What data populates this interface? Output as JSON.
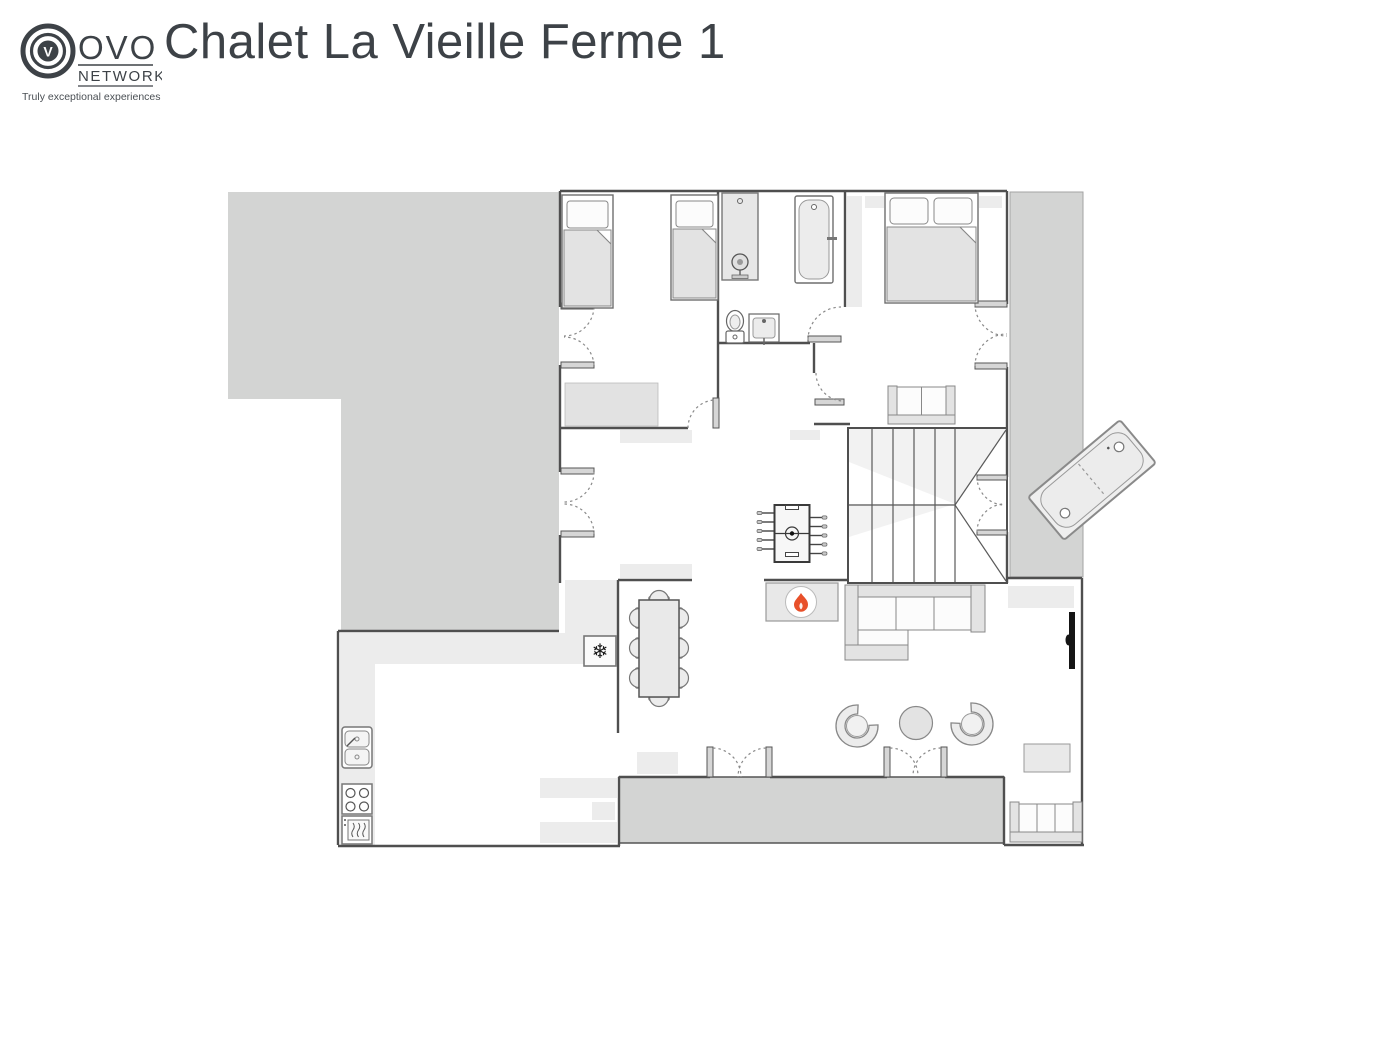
{
  "header": {
    "title": "Chalet La Vieille Ferme 1",
    "logo": {
      "ovo": "OVO",
      "network": "NETWORK",
      "tagline": "Truly exceptional experiences",
      "monogram": "V"
    }
  },
  "colors": {
    "ink": "#3d4247",
    "wall": "#4f4f4f",
    "terrace": "#d3d4d3",
    "counter": "#ececec",
    "flame": "#e8502a"
  },
  "icons": {
    "fridge": {
      "name": "snowflake-icon",
      "glyph": "❄"
    },
    "fireplace": {
      "name": "flame-icon"
    },
    "shower": {
      "name": "shower-head-icon"
    },
    "tv": {
      "name": "tv-icon"
    }
  },
  "floorplan": {
    "areas": [
      "upper-terrace",
      "twin-bedroom",
      "bathroom",
      "double-bedroom",
      "side-balcony",
      "hallway",
      "stairwell",
      "kitchen",
      "dining-area",
      "living-room",
      "lower-terrace"
    ],
    "furniture": [
      "single-bed",
      "single-bed",
      "wardrobe",
      "shower",
      "bathtub",
      "toilet",
      "washbasin",
      "double-bed",
      "nightstand",
      "nightstand",
      "loveseat",
      "staircase",
      "hot-tub",
      "foosball-table",
      "fireplace",
      "corner-sofa",
      "armchair",
      "armchair",
      "round-coffee-table",
      "wall-tv",
      "sideboard",
      "side-table",
      "bench-sofa",
      "dining-table",
      "dining-chairs-x8",
      "fridge",
      "double-sink",
      "hob",
      "oven",
      "kitchen-counter"
    ]
  }
}
